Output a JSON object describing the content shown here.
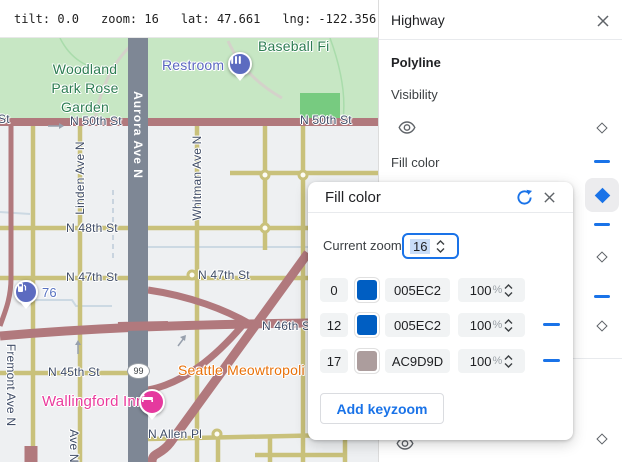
{
  "topbar": {
    "items": [
      "tilt: 0.0",
      "zoom: 16",
      "lat: 47.661",
      "lng: -122.356"
    ]
  },
  "panel": {
    "title": "Highway",
    "section": "Polyline",
    "visibility_label": "Visibility",
    "fill_color_label": "Fill color"
  },
  "dialog": {
    "title": "Fill color",
    "current_zoom_label": "Current zoom",
    "current_zoom_value": "16",
    "percent_suffix": "%",
    "rows": [
      {
        "zoom": "0",
        "hex": "005EC2",
        "swatch": "#005EC2",
        "opacity": "100"
      },
      {
        "zoom": "12",
        "hex": "005EC2",
        "swatch": "#005EC2",
        "opacity": "100"
      },
      {
        "zoom": "17",
        "hex": "AC9D9D",
        "swatch": "#AC9D9D",
        "opacity": "100"
      }
    ],
    "add_button": "Add keyzoom"
  },
  "map": {
    "labels": {
      "park_line1": "Woodland",
      "park_line2": "Park Rose",
      "park_line3": "Garden",
      "restroom": "Restroom",
      "baseball": "Baseball Fi",
      "st_edge": "St",
      "n50th_left": "N 50th St",
      "n50th_right": "N 50th St",
      "aurora": "Aurora Ave N",
      "linden": "Linden Ave N",
      "whitman": "Whitman Ave N",
      "fremont": "Fremont Ave N",
      "ave_n": "Ave N",
      "n48th": "N 48th St",
      "n47th_left": "N 47th St",
      "n47th_right": "N 47th St",
      "n46th": "N 46th St",
      "n45th": "N 45th St",
      "n_allen": "N Allen Pl",
      "gas": "76",
      "route_shield": "99",
      "seattle": "Seattle Meowtropoli",
      "wallingford": "Wallingford Inn"
    }
  },
  "colors": {
    "accent": "#1a73e8",
    "swatch_blue": "#005EC2",
    "swatch_mauve": "#AC9D9D",
    "highway_road": "#b1797d",
    "arterial_road": "#c9c17b",
    "aurora_road": "#7e8795",
    "park_green": "#c7e7c4"
  }
}
